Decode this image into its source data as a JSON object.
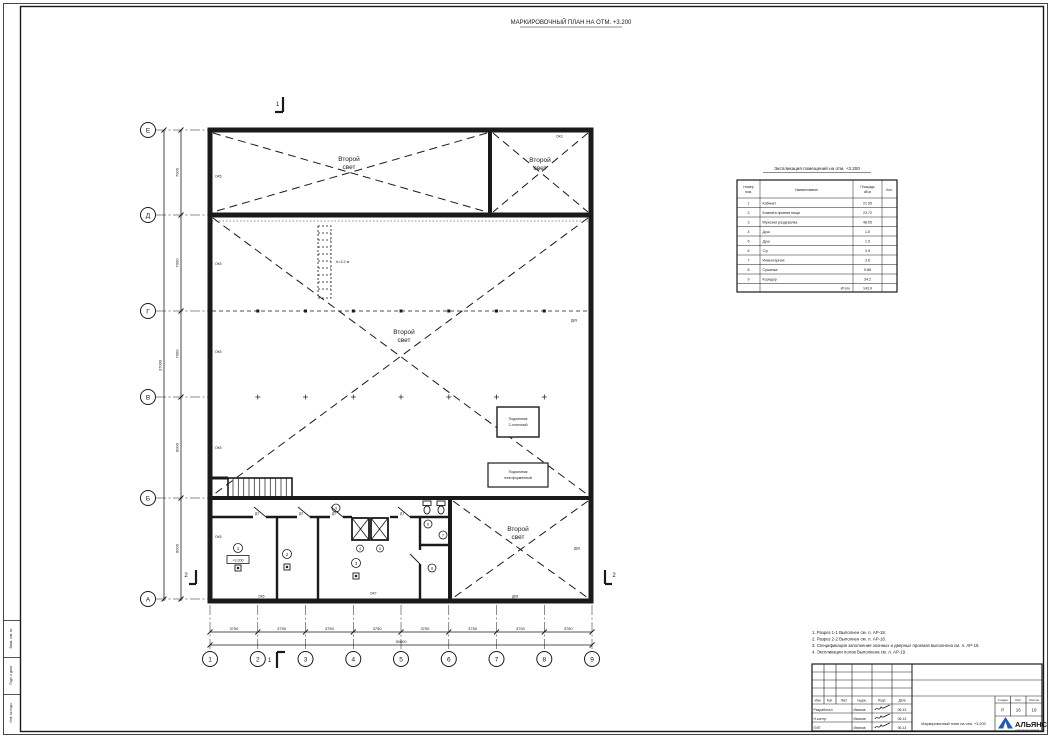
{
  "sheet_title": "МАРКИРОВОЧНЫЙ ПЛАН НА ОТМ. +3.200",
  "axes": {
    "rows": [
      "Е",
      "Д",
      "Г",
      "В",
      "Б",
      "А"
    ],
    "cols": [
      "1",
      "2",
      "3",
      "4",
      "5",
      "6",
      "7",
      "8",
      "9"
    ]
  },
  "dims": {
    "bottom": [
      "3750",
      "3750",
      "3750",
      "3750",
      "3750",
      "3750",
      "3750",
      "3750"
    ],
    "bottom_total": "30000",
    "left": [
      "7000",
      "7000",
      "7000",
      "8000",
      "8000"
    ],
    "left_total": "37000"
  },
  "labels": {
    "second_light_l1": "Второй",
    "second_light_l2": "свет",
    "ladder": "h=3.2 м",
    "level": "+3.200",
    "lift1_l1": "Подъемник",
    "lift1_l2": "2-стоечный",
    "lift2_l1": "Подъемник",
    "lift2_l2": "платформенный"
  },
  "marks": {
    "ok3": "ОК3",
    "ok5": "ОК5",
    "ok6": "ОК6",
    "ok7": "ОК7",
    "dk8": "ДК8",
    "dk9": "ДК9",
    "dk6": "ДК6",
    "d1": "Д1",
    "d2": "Д2",
    "d3": "Д3"
  },
  "sections": {
    "s1": "1",
    "s2": "2"
  },
  "room_tags": [
    "1",
    "2",
    "3",
    "4",
    "5",
    "6",
    "7",
    "8",
    "9"
  ],
  "table": {
    "title": "Экспликация помещений на отм. +3.200",
    "headers": {
      "num_l1": "Номер",
      "num_l2": "пом.",
      "name": "Наименование",
      "area_l1": "Площадь",
      "area_l2": "кВ.м",
      "qty": "Кол."
    },
    "rows": [
      {
        "num": "1",
        "name": "Кабинет",
        "area": "21.55"
      },
      {
        "num": "2",
        "name": "Комната приема пищи",
        "area": "23.72"
      },
      {
        "num": "3",
        "name": "Мужская раздевалка",
        "area": "48.05"
      },
      {
        "num": "4",
        "name": "Душ",
        "area": "1.5"
      },
      {
        "num": "5",
        "name": "Душ",
        "area": "1.5"
      },
      {
        "num": "6",
        "name": "С/у",
        "area": "3.9"
      },
      {
        "num": "7",
        "name": "Инвентарная",
        "area": "3.6"
      },
      {
        "num": "8",
        "name": "Сушилка",
        "area": "5.88"
      },
      {
        "num": "9",
        "name": "Коридор",
        "area": "34.2"
      }
    ],
    "total_label": "Итого",
    "total": "143.9"
  },
  "notes": [
    "1. Разрез 1-1 Выполнен см. л. АР-18.",
    "2. Разрез 2-2 Выполнен см. л. АР-18.",
    "3. Спецификация заполнения оконных и дверных проемов выполнена см. л. АР-19.",
    "4. Экспликация полов Выполнена см. л. АР-19."
  ],
  "title_block": {
    "cols": [
      "Изм.",
      "Кол.",
      "Лист",
      "№док.",
      "Подп.",
      "Дата"
    ],
    "rows": [
      {
        "role": "Разработал",
        "name": "Иванов",
        "date": "06.13"
      },
      {
        "role": "Н.контр.",
        "name": "Иванов",
        "date": "06.13"
      },
      {
        "role": "ГИП",
        "name": "Иванов",
        "date": "06.13"
      }
    ],
    "doc_title": "Маркировочный план на отм. +3.200",
    "stage_label": "Стадия",
    "sheet_label": "Лист",
    "sheets_label": "Листов",
    "stage": "Р",
    "sheet": "16",
    "sheets": "19",
    "company": "АЛЬЯНС",
    "company_sub": "строительная компания"
  },
  "side_stamp": [
    "Взам. инв. №",
    "Подп. и дата",
    "Инв. № подл."
  ],
  "colors": {
    "brand_blue": "#1b5cad",
    "line": "#1a1a1a"
  }
}
